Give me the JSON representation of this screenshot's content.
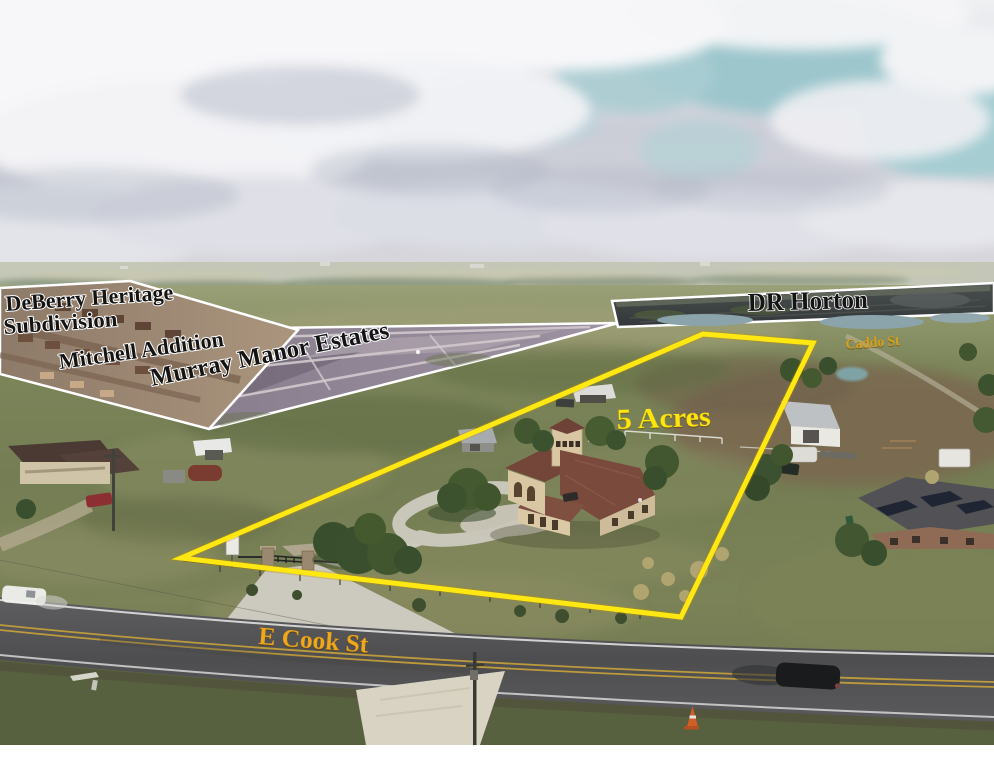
{
  "labels": {
    "deberry_line1": "DeBerry Heritage",
    "deberry_line2": "Subdivision",
    "mitchell": "Mitchell Addition",
    "murray": "Murray Manor Estates",
    "dr_horton": "DR Horton",
    "caddo_street": "Caddo St",
    "acreage": "5 Acres",
    "e_cook_street": "E Cook St"
  },
  "colors": {
    "boundary_yellow": "#ffe712",
    "acreage_yellow": "#ffe60a",
    "street_label_yellow": "#f0a818",
    "caddo_label_yellow": "#d9a31b",
    "subdivision_label_black": "#141414",
    "inset_border_white": "#ffffff"
  }
}
